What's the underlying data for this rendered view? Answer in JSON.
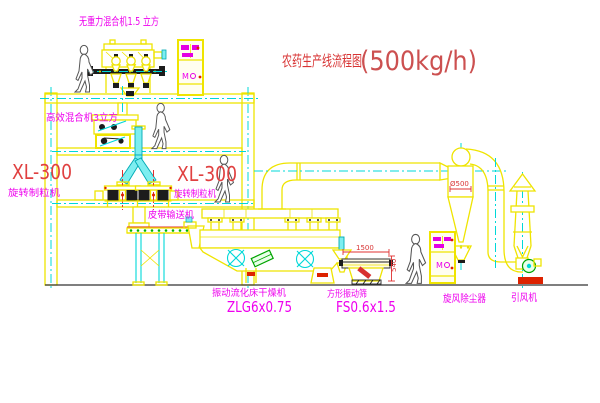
{
  "title": {
    "name": "农药生产线流程图",
    "capacity": "(500kg/h)"
  },
  "equipment_labels": {
    "gravity_free_mixer": "无重力混合机1.5 立方",
    "high_efficiency_mixer": "高效混合机3立方",
    "granulator_left_model": "XL-300",
    "granulator_left_name": "旋转制粒机",
    "granulator_right_model": "XL-300",
    "granulator_right_name": "旋转制粒机",
    "belt_conveyor": "皮带输送机",
    "fluid_bed_dryer_name": "振动流化床干燥机",
    "fluid_bed_dryer_model": "ZLG6x0.75",
    "vibrating_screen_name": "方形振动筛",
    "vibrating_screen_model": "FS0.6x1.5",
    "cyclone_dust_collector": "旋风除尘器",
    "induced_draft_fan": "引风机"
  },
  "dimensions": {
    "screen_length": "1500",
    "screen_height": "540",
    "cyclone_diameter": "Ø500"
  },
  "control_panels": {
    "panel_marking": "M"
  },
  "colors": {
    "line_yellow": "#efe400",
    "pipe_cyan": "#7deef0",
    "centerline_cyan": "#00d8d8",
    "label_magenta": "#ee00ee",
    "label_red": "#e04040",
    "title_red": "#d83434",
    "detail_black": "#1c1c1c",
    "motor_green": "#00a400",
    "base_red": "#dd2200",
    "background": "#ffffff"
  }
}
